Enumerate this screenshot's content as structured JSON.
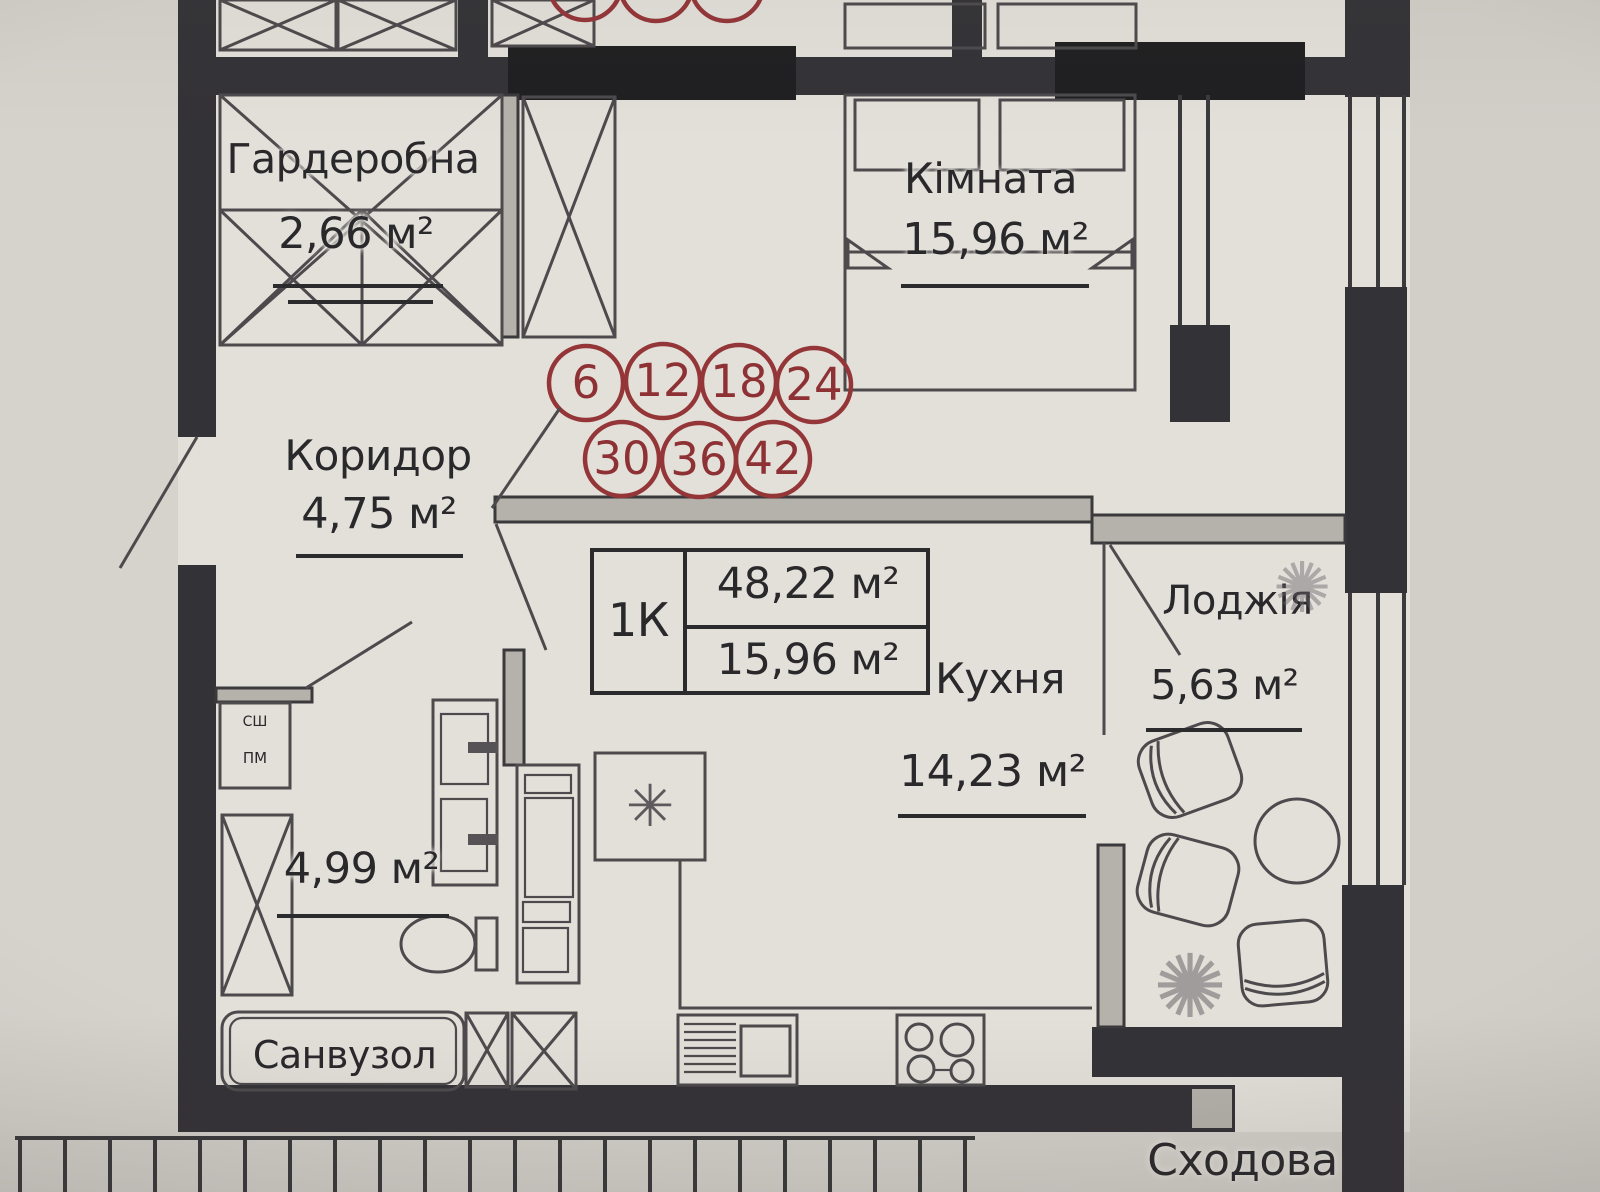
{
  "rooms": [
    {
      "name": "Гардеробна",
      "area": "2,66 м²"
    },
    {
      "name": "Кімната",
      "area": "15,96 м²"
    },
    {
      "name": "Коридор",
      "area": "4,75 м²"
    },
    {
      "name": "Кухня",
      "area": "14,23 м²"
    },
    {
      "name": "Санвузол",
      "area": "4,99 м²"
    },
    {
      "name": "Лоджія",
      "area": "5,63 м²"
    },
    {
      "name": "Сходова",
      "area": ""
    }
  ],
  "info_table": {
    "type": "1К",
    "total_area": "48,22 м²",
    "living_area": "15,96 м²"
  },
  "apartment_numbers": {
    "row1": [
      "6",
      "12",
      "18",
      "24"
    ],
    "row2": [
      "30",
      "36",
      "42"
    ]
  },
  "equipment_labels": {
    "top": "СШ",
    "bottom": "ПМ"
  },
  "icons": {
    "fridge_asterisk": "✳",
    "plant_splat": "✺"
  },
  "colors": {
    "wall": "#333236",
    "line": "#4c4a4c",
    "accent_red": "#943538",
    "paper": "#d8d5d0",
    "floor": "#e3e0da",
    "gray_wall": "#b5b1ab"
  }
}
